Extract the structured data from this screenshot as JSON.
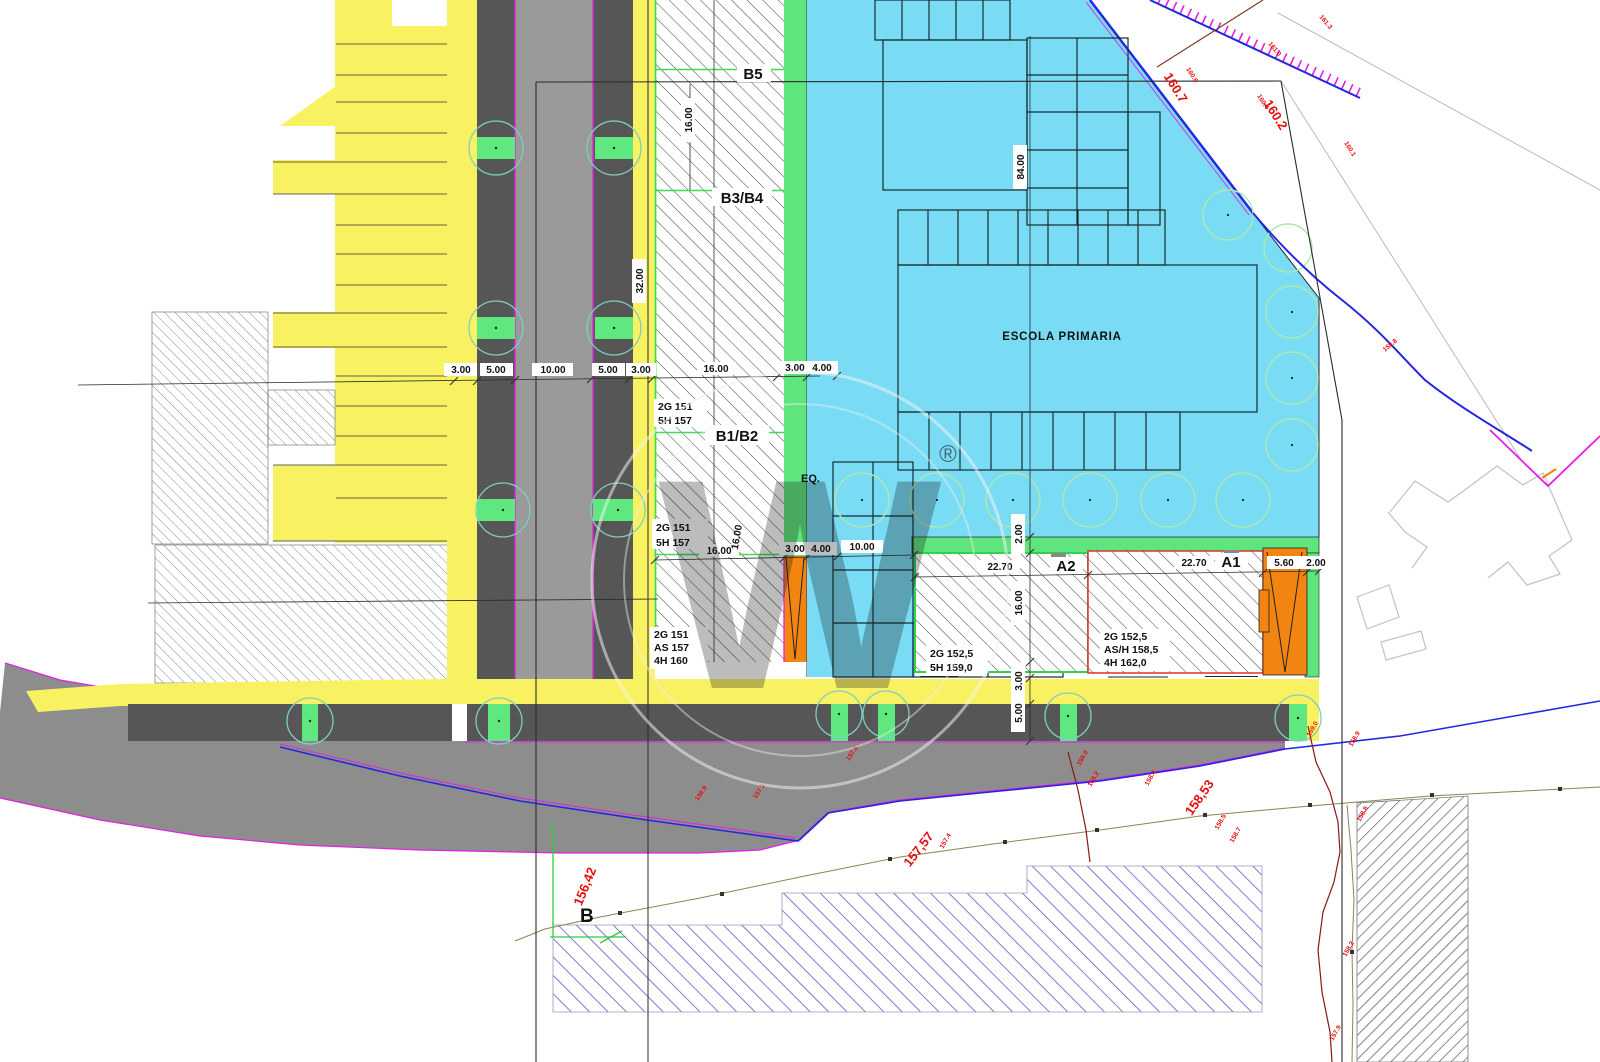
{
  "colors": {
    "yellow": "#f8f263",
    "cyan": "#79dcf4",
    "green": "#5fe57e",
    "pale_tree": "#aee8ad",
    "teal_circle": "#7fcdc4",
    "parking_gray": "#565656",
    "carriageway_gray": "#9a9a9a",
    "existing_road_gray": "#8d8d8d",
    "magenta": "#e51ee5",
    "orange": "#f28511",
    "blue": "#2526e0",
    "red_text": "#e60d0d",
    "olive": "#8b8455",
    "dark_red": "#8c1616",
    "blue_hatch": "#5b5bd0",
    "line_black": "#2b2b2b"
  },
  "school": {
    "label": "ESCOLA PRIMARIA"
  },
  "blocks": {
    "b5": "B5",
    "b3b4": "B3/B4",
    "b1b2": "B1/B2",
    "a2": "A2",
    "a1": "A1",
    "eq": "EQ.",
    "b_point": "B"
  },
  "zoning": {
    "b1b2_upper": {
      "l1": "2G 151",
      "l2": "5H 157"
    },
    "b1b2_mid": {
      "l1": "2G 151",
      "l2": "5H 157"
    },
    "b1b2_lower": {
      "l1": "2G 151",
      "l2": "AS 157",
      "l3": "4H 160"
    },
    "a2": {
      "l1": "2G 152,5",
      "l2": "5H 159,0"
    },
    "a1": {
      "l1": "2G  152,5",
      "l2": "AS/H 158,5",
      "l3": "4H  162,0"
    }
  },
  "dimensions": {
    "top": [
      "3.00",
      "5.00",
      "10.00",
      "5.00",
      "3.00",
      "16.00",
      "3.00",
      "4.00"
    ],
    "mid": [
      "16.00",
      "3.00",
      "4.00",
      "10.00"
    ],
    "a_row": [
      "22.70",
      "22.70",
      "5.60",
      "2.00"
    ],
    "rotated": {
      "b5_depth": "16.00",
      "road_length": "32.00",
      "b1b2_depth": "16.00",
      "school_depth": "84.00",
      "green_walk": "2.00",
      "a_depth": "16.00",
      "sidewalk": "3.00",
      "parking": "5.00"
    }
  },
  "elevations": {
    "major": [
      "160.7",
      "160.2",
      "156,42",
      "157,57",
      "158,53"
    ],
    "minor": [
      "160.6",
      "160.4",
      "160.1",
      "161.3",
      "161.0",
      "157.8",
      "158.2",
      "158.4",
      "158.5",
      "158.7",
      "159.0",
      "158.9",
      "158.8",
      "158.2",
      "157.9",
      "157.4",
      "157.1",
      "158.0",
      "156.9",
      "159.8"
    ]
  },
  "watermark": {
    "reg": "®",
    "letter": "W"
  }
}
